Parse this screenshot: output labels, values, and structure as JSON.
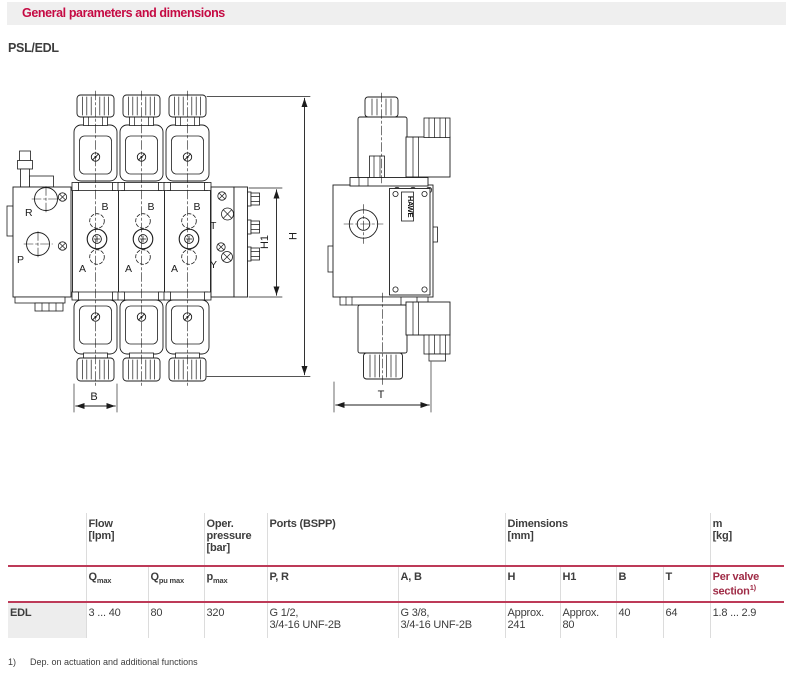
{
  "colors": {
    "accent_red": "#c50a43",
    "table_line_red": "#bd3a58",
    "highlight_column_red": "#9f2b46",
    "header_bar_bg": "#efefef",
    "row_label_bg": "#ededed",
    "text_dark": "#3d3d3d",
    "drawing_line": "#1c1c1c"
  },
  "header": {
    "title": "General parameters and dimensions"
  },
  "model": "PSL/EDL",
  "drawing": {
    "front_view": {
      "label_r": "R",
      "label_p": "P",
      "label_b": "B",
      "label_a": "A",
      "label_t": "T",
      "label_y": "Y",
      "dim_h": "H",
      "dim_h1": "H1",
      "dim_b": "B"
    },
    "side_view": {
      "logo": "HAWE",
      "dim_t": "T"
    }
  },
  "table": {
    "group_headers": [
      "",
      "Flow\n[lpm]",
      "Oper.\npressure\n[bar]",
      "Ports (BSPP)",
      "Dimensions\n[mm]",
      "m\n[kg]"
    ],
    "subheaders": [
      {
        "main": "Q",
        "sub": "max"
      },
      {
        "main": "Q",
        "sub": "pu max"
      },
      {
        "main": "p",
        "sub": "max"
      },
      {
        "main": "P, R"
      },
      {
        "main": "A, B"
      },
      {
        "main": "H"
      },
      {
        "main": "H1"
      },
      {
        "main": "B"
      },
      {
        "main": "T"
      },
      {
        "main": "Per valve section",
        "sup": "1)"
      }
    ],
    "rows": [
      {
        "label": "EDL",
        "values": [
          "3 ... 40",
          "80",
          "320",
          "G 1/2,\n3/4-16 UNF-2B",
          "G 3/8,\n3/4-16 UNF-2B",
          "Approx.\n241",
          "Approx.\n80",
          "40",
          "64",
          "1.8 ... 2.9"
        ]
      }
    ]
  },
  "footnote": {
    "marker": "1)",
    "text": "Dep. on actuation and additional functions"
  }
}
